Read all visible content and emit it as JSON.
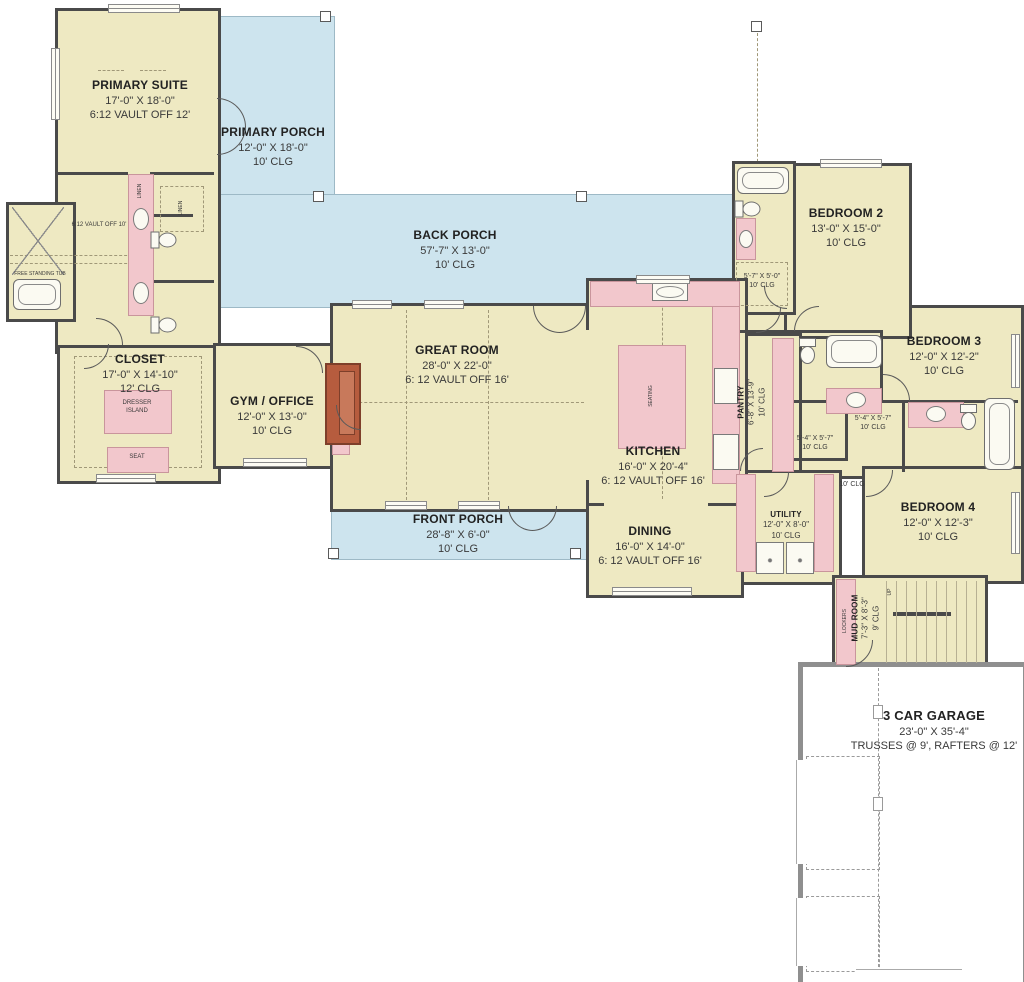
{
  "colors": {
    "floor": "#EEE9C2",
    "porch": "#CDE4EE",
    "cabinetry": "#F2C7CC",
    "wall": "#4A4A4A",
    "fireplace": "#B65C3E"
  },
  "rooms": {
    "primary_suite": {
      "name": "PRIMARY SUITE",
      "dims": "17'-0\" X 18'-0\"",
      "note": "6:12 VAULT OFF 12'"
    },
    "primary_porch": {
      "name": "PRIMARY PORCH",
      "dims": "12'-0\" X 18'-0\"",
      "note": "10' CLG"
    },
    "back_porch": {
      "name": "BACK PORCH",
      "dims": "57'-7\" X 13'-0\"",
      "note": "10' CLG"
    },
    "front_porch": {
      "name": "FRONT PORCH",
      "dims": "28'-8\" X 6'-0\"",
      "note": "10' CLG"
    },
    "great_room": {
      "name": "GREAT ROOM",
      "dims": "28'-0\" X 22'-0\"",
      "note": "6: 12 VAULT OFF 16'"
    },
    "kitchen": {
      "name": "KITCHEN",
      "dims": "16'-0\" X 20'-4\"",
      "note": "6: 12 VAULT OFF 16'"
    },
    "dining": {
      "name": "DINING",
      "dims": "16'-0\" X 14'-0\"",
      "note": "6: 12 VAULT OFF 16'"
    },
    "pantry": {
      "name": "PANTRY",
      "dims": "6'-8\" X 13'-9\"",
      "note": "10' CLG"
    },
    "closet": {
      "name": "CLOSET",
      "dims": "17'-0\" X 14'-10\"",
      "note": "12' CLG"
    },
    "gym_office": {
      "name": "GYM / OFFICE",
      "dims": "12'-0\" X 13'-0\"",
      "note": "10' CLG"
    },
    "bedroom2": {
      "name": "BEDROOM 2",
      "dims": "13'-0\" X 15'-0\"",
      "note": "10' CLG"
    },
    "bedroom3": {
      "name": "BEDROOM 3",
      "dims": "12'-0\" X 12'-2\"",
      "note": "10' CLG"
    },
    "bedroom4": {
      "name": "BEDROOM 4",
      "dims": "12'-0\" X 12'-3\"",
      "note": "10' CLG"
    },
    "bedroom2_closet": {
      "dims": "5'-7\" X 5'-0\"",
      "note": "10' CLG"
    },
    "wic_mid": {
      "dims": "5'-4\" X 5'-7\"",
      "note": "10' CLG"
    },
    "wic_left": {
      "dims": "5'-4\" X 5'-7\"",
      "note": "10' CLG"
    },
    "utility": {
      "name": "UTILITY",
      "dims": "12'-0\" X 8'-0\"",
      "note": "10' CLG"
    },
    "mud_room": {
      "name": "MUD ROOM",
      "dims": "7'-3\" X 8'-3\"",
      "note": "9' CLG"
    },
    "garage": {
      "name": "3 CAR GARAGE",
      "dims": "23'-0\" X 35'-4\"",
      "note": "TRUSSES @ 9', RAFTERS @ 12'"
    },
    "hall": {
      "note": "10' CLG"
    },
    "primary_bath": {
      "note": "6:12 VAULT OFF 10'"
    }
  },
  "furniture": {
    "dresser_island": "DRESSER ISLAND",
    "seat": "SEAT",
    "seating": "SEATING",
    "lockers": "LOCKERS",
    "linen": "LINEN",
    "free_standing_tub": "FREE STANDING TUB",
    "up": "UP"
  }
}
